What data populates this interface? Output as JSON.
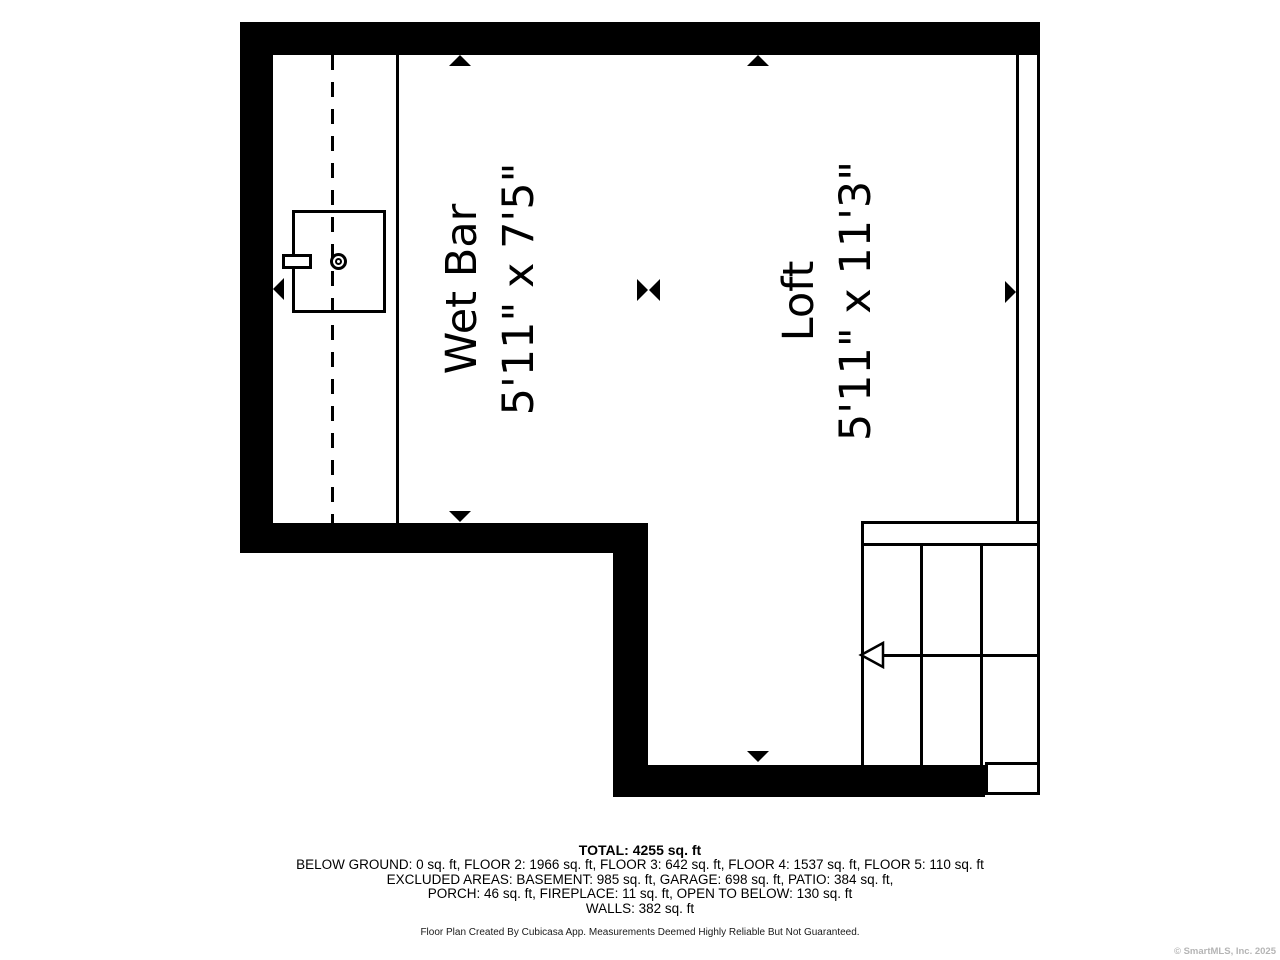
{
  "plan": {
    "rooms": [
      {
        "name": "Wet Bar",
        "dimensions": "5'11\" x 7'5\""
      },
      {
        "name": "Loft",
        "dimensions": "5'11\" x 11'3\""
      }
    ],
    "fixtures": [
      "wet-bar-sink"
    ],
    "stairs": {
      "direction_arrow": "left"
    }
  },
  "areas": {
    "total_sq_ft": 4255,
    "below_ground": 0,
    "floor_2": 1966,
    "floor_3": 642,
    "floor_4": 1537,
    "floor_5": 110,
    "excluded": {
      "basement": 985,
      "garage": 698,
      "patio": 384,
      "porch": 46,
      "fireplace": 11,
      "open_to_below": 130
    },
    "walls": 382
  },
  "footer": {
    "total": "TOTAL: 4255 sq. ft",
    "floors": "BELOW GROUND: 0 sq. ft, FLOOR 2: 1966 sq. ft, FLOOR 3: 642 sq. ft, FLOOR 4: 1537 sq. ft, FLOOR 5: 110 sq. ft",
    "excluded1": "EXCLUDED AREAS: BASEMENT: 985 sq. ft, GARAGE: 698 sq. ft, PATIO: 384 sq. ft,",
    "excluded2": "PORCH: 46 sq. ft, FIREPLACE: 11 sq. ft, OPEN TO BELOW: 130 sq. ft",
    "walls": "WALLS: 382 sq. ft",
    "disclaimer": "Floor Plan Created By Cubicasa App. Measurements Deemed Highly Reliable But Not Guaranteed.",
    "copyright": "© SmartMLS, Inc. 2025"
  },
  "icons": {
    "dimension_arrow": "filled black triangle",
    "stair_direction_arrow": "outlined triangle pointing left",
    "sink": "square counter with faucet ring"
  },
  "colors": {
    "walls": "#000000",
    "background": "#ffffff",
    "text": "#000000",
    "copyright_text": "#b5b5b5"
  }
}
